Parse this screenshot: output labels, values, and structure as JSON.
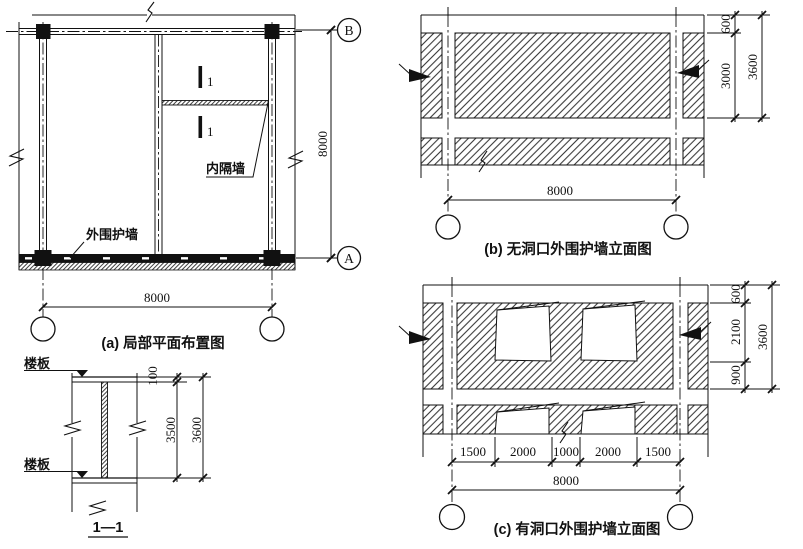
{
  "drawing": {
    "plan": {
      "title": "(a) 局部平面布置图",
      "label_interior_wall": "内隔墙",
      "label_exterior_wall": "外围护墙",
      "section_mark_1": "1",
      "section_mark_2": "1",
      "grid_bubble_top": "B",
      "grid_bubble_bottom": "A",
      "dim_vertical": "8000",
      "dim_horizontal": "8000"
    },
    "section": {
      "title": "1—1",
      "label_slab_top": "楼板",
      "label_slab_bottom": "楼板",
      "dim_slab": "100",
      "dim_clear": "3500",
      "dim_story": "3600"
    },
    "elevation_no_opening": {
      "title": "(b) 无洞口外围护墙立面图",
      "dim_belt": "600",
      "dim_panel": "3000",
      "dim_story": "3600",
      "dim_span": "8000"
    },
    "elevation_with_opening": {
      "title": "(c) 有洞口外围护墙立面图",
      "dim_belt": "600",
      "dim_window": "2100",
      "dim_below_window": "900",
      "dim_story": "3600",
      "dim_span": "8000",
      "dim_segments": [
        "1500",
        "2000",
        "1000",
        "2000",
        "1500"
      ]
    },
    "line_color": "#111111",
    "background": "#ffffff"
  }
}
